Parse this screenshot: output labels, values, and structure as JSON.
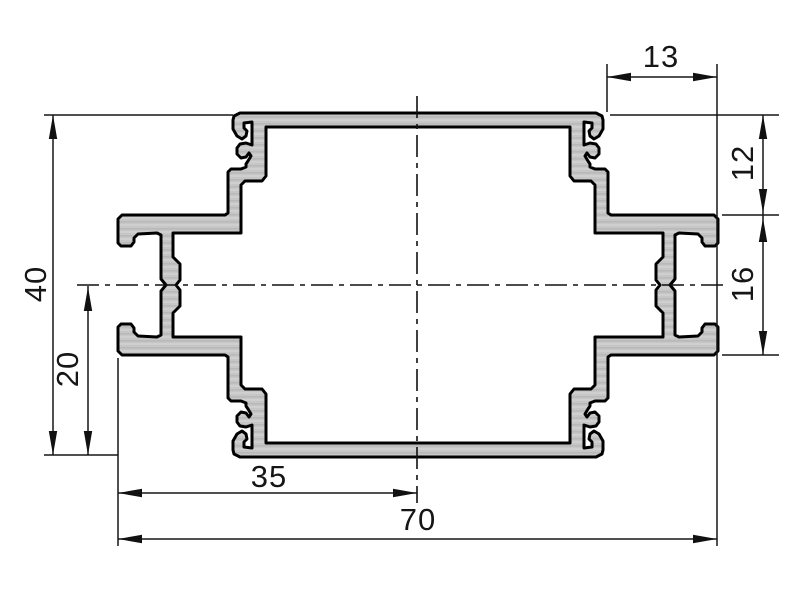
{
  "drawing": {
    "dimensions": {
      "total_height": "40",
      "half_height": "20",
      "half_width": "35",
      "total_width": "70",
      "top_notch_width": "13",
      "upper_step_height": "12",
      "flange_span": "16"
    },
    "colors": {
      "profile_fill": "#c6c6c6",
      "line_color": "#161616",
      "background": "#ffffff"
    }
  }
}
